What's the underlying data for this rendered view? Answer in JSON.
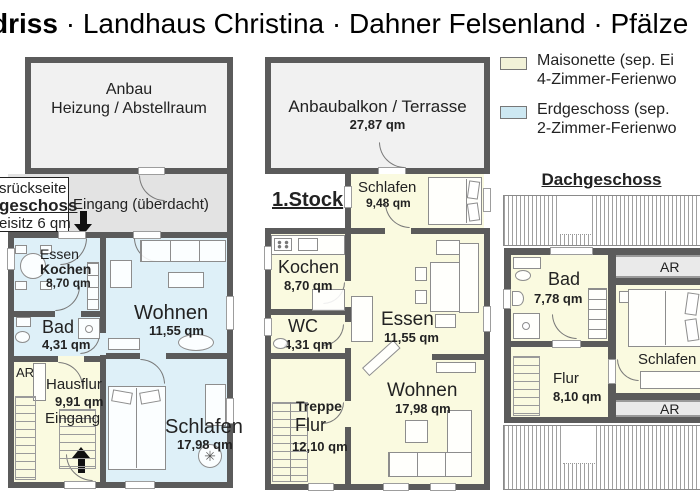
{
  "title": {
    "bold_fragment": "driss",
    "rest": " · Landhaus Christina · Dahner Felsenland · Pfälze"
  },
  "legend": {
    "items": [
      {
        "color": "#F2F2D8",
        "line1": "Maisonette (sep. Ei",
        "line2": "4-Zimmer-Ferienwo"
      },
      {
        "color": "#CDE8F2",
        "line1": "Erdgeschoss (sep.",
        "line2": "2-Zimmer-Ferienwo"
      }
    ]
  },
  "colors": {
    "wall": "#5b5b5b",
    "maisonette_room": "#FAFAE0",
    "erdgeschoss_room": "#DEF0F8",
    "annex_fill": "#F1F1F1",
    "entry_fill": "#E3E3E3",
    "ar_strip_fill": "#EAEAEA"
  },
  "icons": {
    "ceiling_fan": "✳"
  },
  "eg": {
    "side_note": {
      "line1": "srückseite",
      "line2": "geschoss",
      "line3": "eisitz 6 qm"
    },
    "anbau": {
      "name": "Anbau",
      "subtitle": "Heizung / Abstellraum"
    },
    "entry_label": "Eingang (überdacht)",
    "rooms": {
      "essen_kochen": {
        "line1": "Essen",
        "line2": "Kochen",
        "area": "8,70 qm"
      },
      "wohnen": {
        "name": "Wohnen",
        "area": "11,55 qm"
      },
      "bad": {
        "name": "Bad",
        "area": "4,31 qm"
      },
      "hausflur": {
        "ar": "AR",
        "name": "Hausflur",
        "area": "9,91 qm",
        "sub": "Eingang"
      },
      "schlafen": {
        "name": "Schlafen",
        "area": "17,98 qm"
      }
    }
  },
  "og": {
    "label": "1.Stock",
    "terrasse": {
      "name": "Anbaubalkon / Terrasse",
      "area": "27,87 qm"
    },
    "rooms": {
      "schlafen": {
        "name": "Schlafen",
        "area": "9,48 qm"
      },
      "kochen": {
        "name": "Kochen",
        "area": "8,70 qm"
      },
      "wc": {
        "name": "WC",
        "area": "4,31 qm"
      },
      "essen": {
        "name": "Essen",
        "area": "11,55 qm"
      },
      "wohnen": {
        "name": "Wohnen",
        "area": "17,98 qm"
      },
      "treppe_flur": {
        "line1": "Treppe",
        "line2": "Flur",
        "area": "12,10 qm"
      }
    }
  },
  "dg": {
    "label": "Dachgeschoss",
    "rooms": {
      "bad": {
        "name": "Bad",
        "area": "7,78 qm"
      },
      "ar_top": "AR",
      "ar_bottom": "AR",
      "schlafen": {
        "name": "Schlafen 1"
      },
      "flur": {
        "name": "Flur",
        "area": "8,10 qm"
      }
    }
  }
}
